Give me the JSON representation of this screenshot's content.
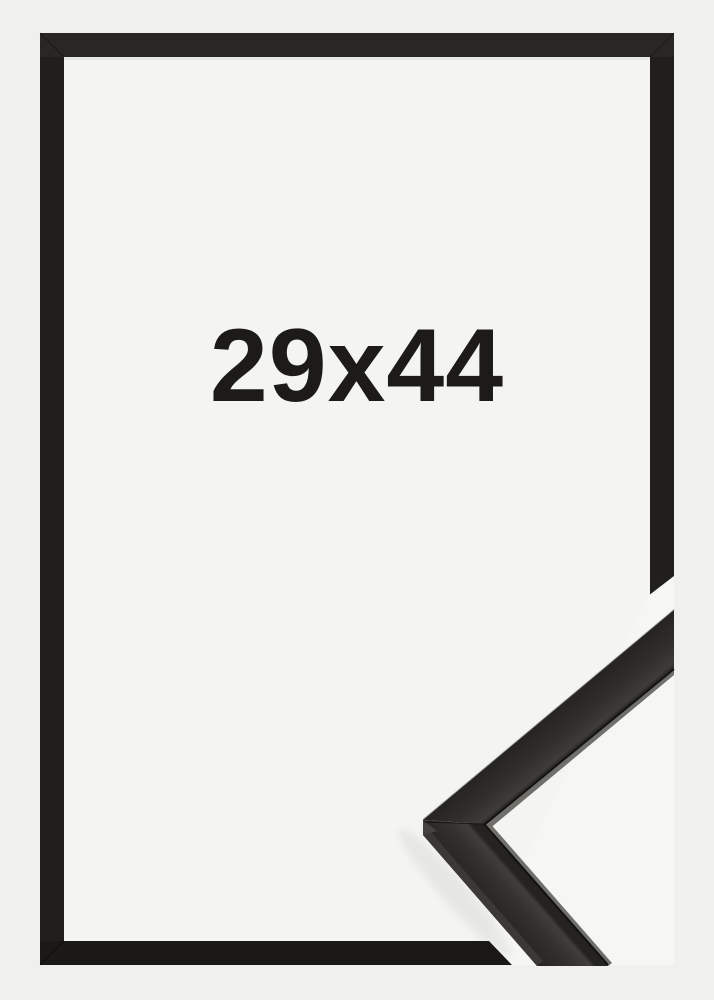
{
  "product": {
    "size_label": "29x44"
  },
  "colors": {
    "background": "#f0f0ef",
    "interior": "#f4f4f3",
    "pocket": "#f6f6f5",
    "frame_top": "#282725",
    "frame_side": "#201f1d",
    "frame_bottom": "#1a1918",
    "text": "#1c1b1a",
    "sample_lip": "#716f6a",
    "sample_side": "#3b3835",
    "sample_facet": "#454240"
  }
}
